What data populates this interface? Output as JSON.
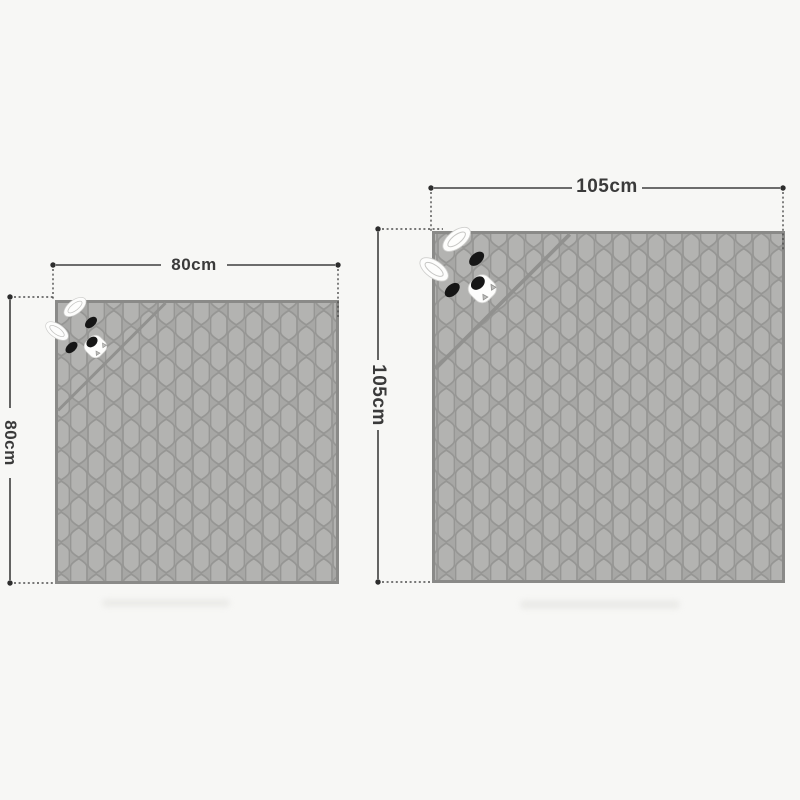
{
  "page": {
    "background_color": "#f7f7f5",
    "subject": "hooded bunny blanket size diagram"
  },
  "blankets": [
    {
      "name": "small",
      "width_label": "80cm",
      "height_label": "80cm",
      "width_cm": 80,
      "height_cm": 80,
      "hood_icon": "bunny-face-icon"
    },
    {
      "name": "large",
      "width_label": "105cm",
      "height_label": "105cm",
      "width_cm": 105,
      "height_cm": 105,
      "hood_icon": "bunny-face-icon"
    }
  ],
  "colors": {
    "fabric_cell": "#b3b3b1",
    "fabric_gap": "#a7a7a5",
    "fabric_outline": "#97978f",
    "blanket_border": "#8a8a88",
    "hood_fold": "#91918f",
    "dimension_line": "#3e3e3e",
    "dimension_text": "#3a3a3a",
    "bunny_white": "#fdfdfc",
    "bunny_black": "#161616"
  }
}
